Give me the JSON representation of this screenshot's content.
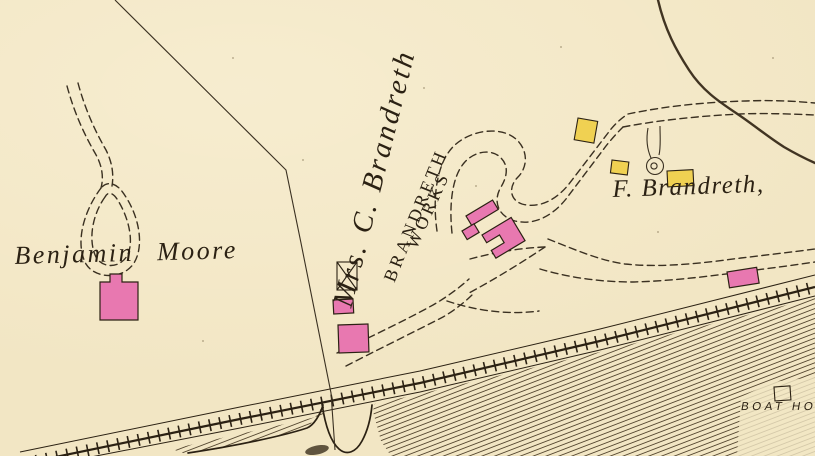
{
  "map": {
    "description": "Historic cadastral atlas map detail with property owners, buildings, winding dashed roads, a railroad along a hachured river bank, and a boat house",
    "labels": {
      "benjamin_moore": "Benjamin Moore",
      "mrs_c_brandreth": "Mrs. C. Brandreth",
      "works_line1": "BRANDRETH",
      "works_line2": "WORKS",
      "f_brandreth": "F. Brandreth,",
      "boat_house": "BOAT HO"
    }
  },
  "colors": {
    "paper": "#f2e6c4",
    "ink": "#2b2113",
    "road": "#3a3021",
    "stream": "#413422",
    "hatch": "#4a3c26",
    "pink": "#e878b0",
    "yellow": "#f0d152"
  }
}
